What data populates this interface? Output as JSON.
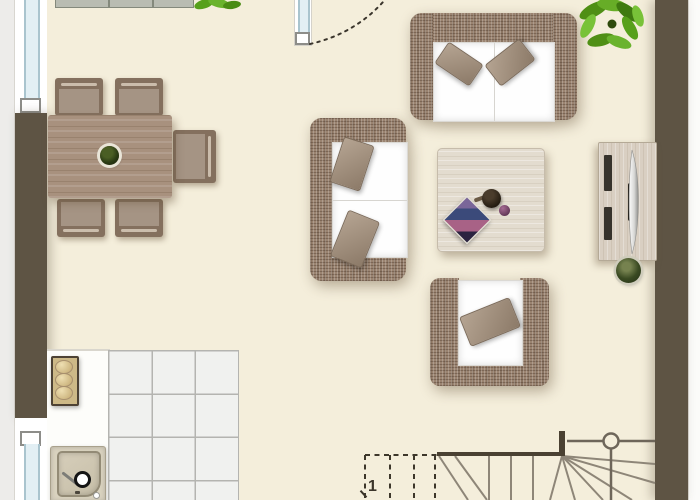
{
  "plan": {
    "type": "apartment-floor-plan-top-view",
    "stairs": {
      "step_label": "1"
    },
    "rooms": [
      "living-dining-room",
      "kitchen",
      "staircase-corner"
    ],
    "furniture": [
      "dining-table-with-centerpiece",
      "dining-chair-top-1",
      "dining-chair-top-2",
      "dining-chair-bottom-1",
      "dining-chair-bottom-2",
      "dining-chair-right",
      "wicker-sofa-horizontal",
      "wicker-sofa-vertical",
      "wicker-armchair",
      "coffee-table-with-bowl-magazine",
      "tv-sideboard-with-flatscreen",
      "floor-plant-pot",
      "kitchen-counter",
      "cooktop-3-burners",
      "kitchen-sink",
      "winder-staircase",
      "potted-plant-large",
      "potted-plant-small",
      "top-wall-cabinet"
    ],
    "openings": [
      "window-left-top",
      "window-left-bottom",
      "door-top-with-swing-arc"
    ]
  },
  "colors": {
    "floor": "#f4eedb",
    "wall": "#5e5444",
    "wicker": "#9a8370",
    "cushion_white": "#fefefe",
    "pillow_taupe": "#a5937f",
    "table_wood": "#a8917e",
    "light_wood": "#e3dccf",
    "cabinet_wood": "#d9cfc2",
    "tile": "#f0f1ef",
    "grout": "#b4b4b0",
    "glass_blue": "#e2eff4",
    "plant_green": "#5a9b1d",
    "stair_line_dark": "#4a4132",
    "stair_line_mid": "#8e8678"
  }
}
